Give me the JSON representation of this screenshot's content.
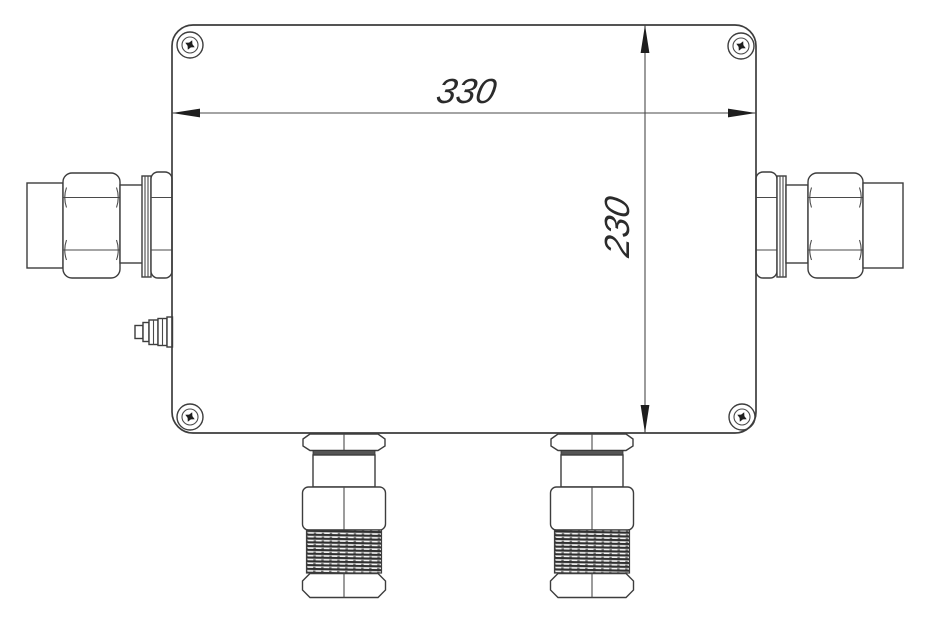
{
  "drawing": {
    "title": "Enclosure front view with cable glands",
    "dimensions": {
      "width": {
        "label": "330"
      },
      "height": {
        "label": "230"
      }
    },
    "colors": {
      "line": "#3d3d3d",
      "text": "#2b2b2b",
      "background": "#ffffff",
      "thread_dark": "#2f2f2f"
    }
  }
}
